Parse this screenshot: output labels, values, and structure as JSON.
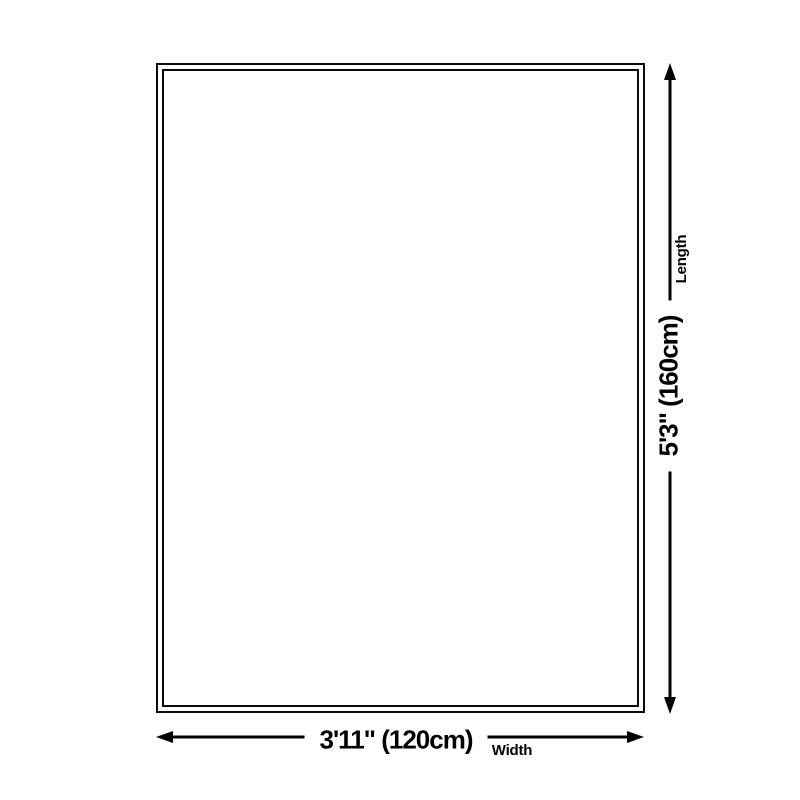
{
  "diagram": {
    "type": "product-size-diagram",
    "length": {
      "measurement": "5'3\" (160cm)",
      "label": "Length"
    },
    "width": {
      "measurement": "3'11\" (120cm)",
      "label": "Width"
    },
    "colors": {
      "line": "#000000",
      "outline": "#0a0a0a",
      "background": "#ffffff",
      "text": "#000000"
    }
  }
}
